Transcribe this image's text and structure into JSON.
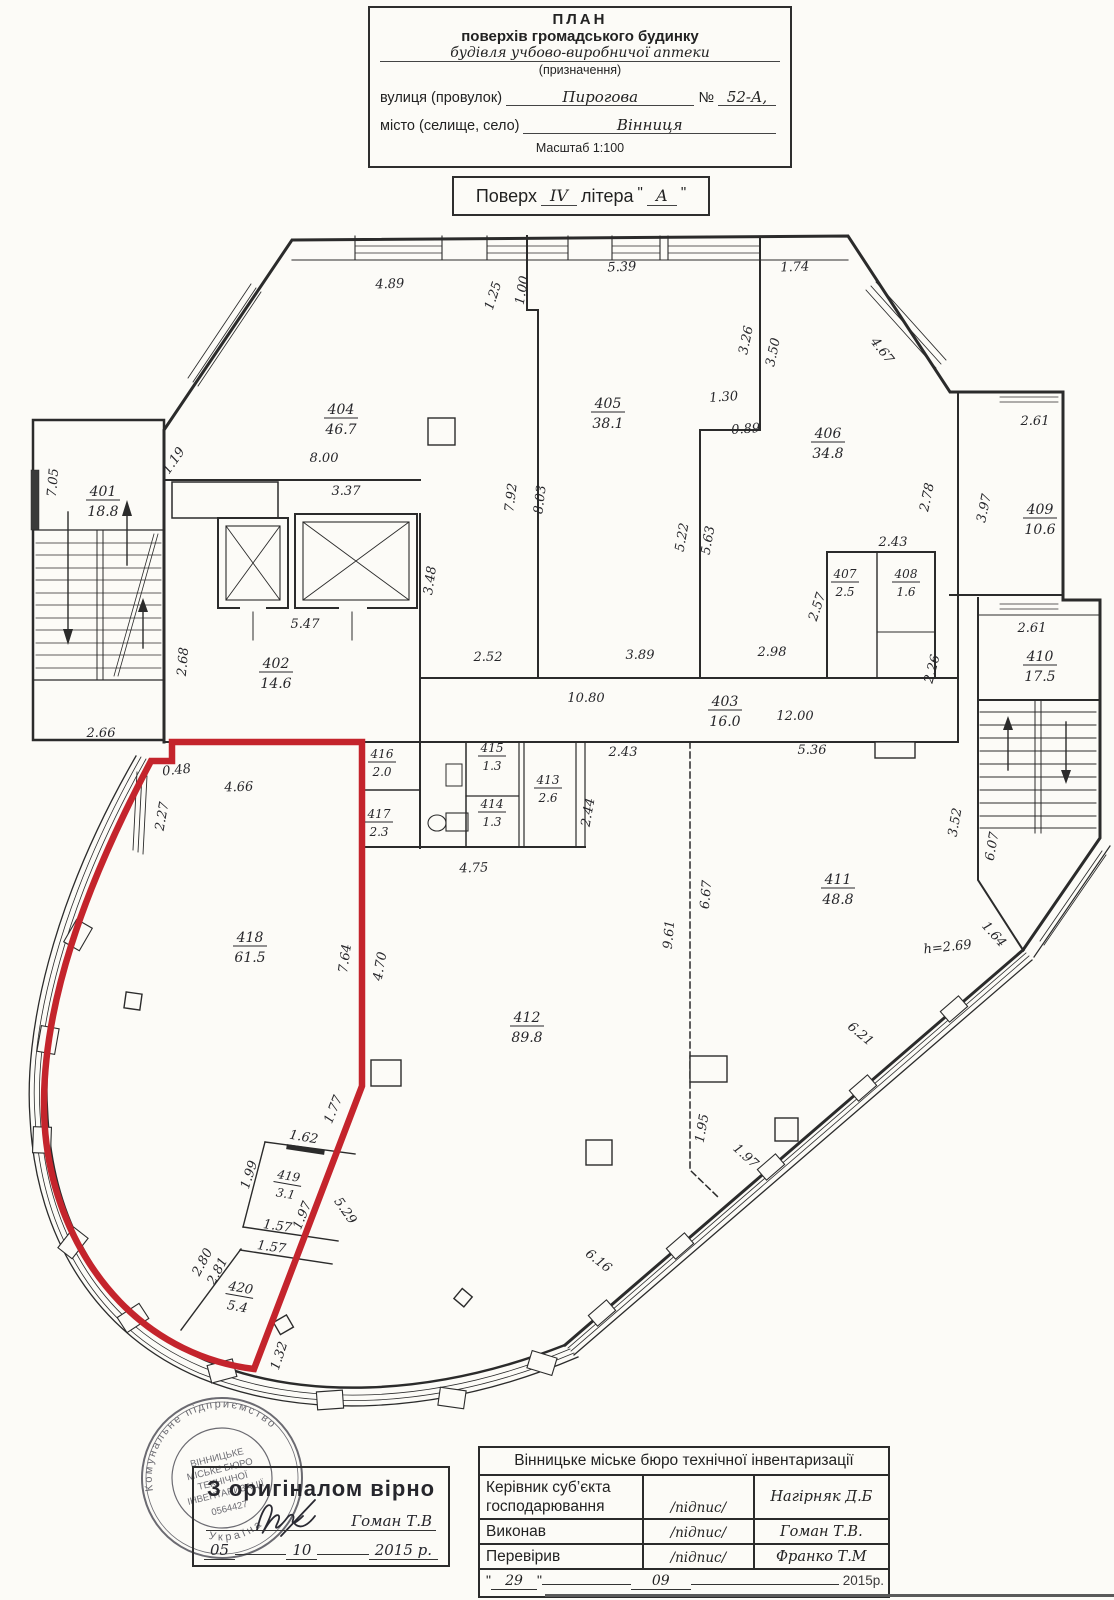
{
  "header": {
    "title_line1": "ПЛАН",
    "title_line2": "поверхів громадського будинку",
    "subtitle_value": "будівля учбово-виробничої аптеки",
    "subtitle_caption": "(призначення)",
    "street_label": "вулиця (провулок)",
    "street_value": "Пирогова",
    "number_label": "№",
    "number_value": "52-А,",
    "city_label": "місто (селище, село)",
    "city_value": "Вінниця",
    "scale": "Масштаб 1:100",
    "floor_label": "Поверх",
    "floor_value": "IV",
    "letter_label": "літера",
    "letter_value": "А",
    "quote": "\""
  },
  "plan": {
    "rooms": [
      {
        "n": "401",
        "a": "18.8",
        "x": 103,
        "y": 496
      },
      {
        "n": "402",
        "a": "14.6",
        "x": 276,
        "y": 668
      },
      {
        "n": "403",
        "a": "16.0",
        "x": 725,
        "y": 706
      },
      {
        "n": "404",
        "a": "46.7",
        "x": 341,
        "y": 414
      },
      {
        "n": "405",
        "a": "38.1",
        "x": 608,
        "y": 408
      },
      {
        "n": "406",
        "a": "34.8",
        "x": 828,
        "y": 438
      },
      {
        "n": "407",
        "a": "2.5",
        "x": 845,
        "y": 578,
        "s": 12
      },
      {
        "n": "408",
        "a": "1.6",
        "x": 906,
        "y": 578,
        "s": 12
      },
      {
        "n": "409",
        "a": "10.6",
        "x": 1040,
        "y": 514
      },
      {
        "n": "410",
        "a": "17.5",
        "x": 1040,
        "y": 661
      },
      {
        "n": "411",
        "a": "48.8",
        "x": 838,
        "y": 884
      },
      {
        "n": "412",
        "a": "89.8",
        "x": 527,
        "y": 1022
      },
      {
        "n": "413",
        "a": "2.6",
        "x": 548,
        "y": 784,
        "s": 12
      },
      {
        "n": "414",
        "a": "1.3",
        "x": 492,
        "y": 808,
        "s": 12
      },
      {
        "n": "415",
        "a": "1.3",
        "x": 492,
        "y": 752,
        "s": 12
      },
      {
        "n": "416",
        "a": "2.0",
        "x": 382,
        "y": 758,
        "s": 12
      },
      {
        "n": "417",
        "a": "2.3",
        "x": 379,
        "y": 818,
        "s": 12
      },
      {
        "n": "418",
        "a": "61.5",
        "x": 250,
        "y": 942
      },
      {
        "n": "419",
        "a": "3.1",
        "x": 288,
        "y": 1180,
        "r": 10,
        "s": 12
      },
      {
        "n": "420",
        "a": "5.4",
        "x": 240,
        "y": 1292,
        "r": 10,
        "s": 13
      }
    ],
    "dims": [
      {
        "t": "4.89",
        "x": 390,
        "y": 288,
        "r": -2
      },
      {
        "t": "5.39",
        "x": 622,
        "y": 271,
        "r": -2
      },
      {
        "t": "1.74",
        "x": 795,
        "y": 271,
        "r": -2
      },
      {
        "t": "1.25",
        "x": 497,
        "y": 297,
        "r": -72
      },
      {
        "t": "1.00",
        "x": 526,
        "y": 291,
        "r": -80
      },
      {
        "t": "3.26",
        "x": 750,
        "y": 341,
        "r": -78
      },
      {
        "t": "3.50",
        "x": 777,
        "y": 353,
        "r": -78
      },
      {
        "t": "4.67",
        "x": 879,
        "y": 353,
        "r": 52
      },
      {
        "t": "2.61",
        "x": 1035,
        "y": 425,
        "r": 0
      },
      {
        "t": "1.19",
        "x": 177,
        "y": 463,
        "r": -55
      },
      {
        "t": "7.05",
        "x": 57,
        "y": 483,
        "r": -85
      },
      {
        "t": "8.00",
        "x": 324,
        "y": 462,
        "r": 0
      },
      {
        "t": "3.37",
        "x": 346,
        "y": 495,
        "r": 0
      },
      {
        "t": "7.92",
        "x": 515,
        "y": 498,
        "r": -83
      },
      {
        "t": "8.03",
        "x": 544,
        "y": 500,
        "r": -83
      },
      {
        "t": "1.30",
        "x": 724,
        "y": 401,
        "r": -4
      },
      {
        "t": "0.89",
        "x": 746,
        "y": 433,
        "r": -4
      },
      {
        "t": "2.78",
        "x": 931,
        "y": 498,
        "r": -78
      },
      {
        "t": "3.97",
        "x": 988,
        "y": 509,
        "r": -78
      },
      {
        "t": "2.43",
        "x": 893,
        "y": 546,
        "r": 0
      },
      {
        "t": "5.22",
        "x": 686,
        "y": 538,
        "r": -80
      },
      {
        "t": "5.63",
        "x": 712,
        "y": 541,
        "r": -80
      },
      {
        "t": "2.57",
        "x": 821,
        "y": 608,
        "r": -72
      },
      {
        "t": "3.48",
        "x": 434,
        "y": 581,
        "r": -82
      },
      {
        "t": "5.47",
        "x": 305,
        "y": 628,
        "r": 0
      },
      {
        "t": "2.68",
        "x": 187,
        "y": 662,
        "r": -85
      },
      {
        "t": "2.52",
        "x": 488,
        "y": 661,
        "r": 0
      },
      {
        "t": "3.89",
        "x": 640,
        "y": 659,
        "r": 0
      },
      {
        "t": "2.98",
        "x": 772,
        "y": 656,
        "r": 0
      },
      {
        "t": "10.80",
        "x": 586,
        "y": 702,
        "r": 0
      },
      {
        "t": "12.00",
        "x": 795,
        "y": 720,
        "r": 0
      },
      {
        "t": "2.66",
        "x": 101,
        "y": 737,
        "r": 0
      },
      {
        "t": "2.26",
        "x": 936,
        "y": 670,
        "r": -75
      },
      {
        "t": "2.61",
        "x": 1032,
        "y": 632,
        "r": 0
      },
      {
        "t": "5.36",
        "x": 812,
        "y": 754,
        "r": 0
      },
      {
        "t": "2.43",
        "x": 623,
        "y": 756,
        "r": 0
      },
      {
        "t": "0.48",
        "x": 177,
        "y": 774,
        "r": -6
      },
      {
        "t": "4.66",
        "x": 239,
        "y": 791,
        "r": -2
      },
      {
        "t": "2.27",
        "x": 166,
        "y": 817,
        "r": -80
      },
      {
        "t": "2.44",
        "x": 592,
        "y": 813,
        "r": -80
      },
      {
        "t": "4.75",
        "x": 474,
        "y": 872,
        "r": -2
      },
      {
        "t": "3.52",
        "x": 959,
        "y": 823,
        "r": -80
      },
      {
        "t": "6.07",
        "x": 996,
        "y": 847,
        "r": -80
      },
      {
        "t": "6.67",
        "x": 710,
        "y": 895,
        "r": -85
      },
      {
        "t": "9.61",
        "x": 673,
        "y": 935,
        "r": -85
      },
      {
        "t": "7.64",
        "x": 349,
        "y": 959,
        "r": -82
      },
      {
        "t": "4.70",
        "x": 384,
        "y": 967,
        "r": -80
      },
      {
        "t": "1.64",
        "x": 991,
        "y": 937,
        "r": 48
      },
      {
        "t": "h=2.69",
        "x": 948,
        "y": 951,
        "r": -6
      },
      {
        "t": "6.21",
        "x": 858,
        "y": 1037,
        "r": 40
      },
      {
        "t": "1.95",
        "x": 706,
        "y": 1129,
        "r": -80
      },
      {
        "t": "1.97",
        "x": 743,
        "y": 1159,
        "r": 42
      },
      {
        "t": "6.16",
        "x": 596,
        "y": 1264,
        "r": 38
      },
      {
        "t": "1.77",
        "x": 337,
        "y": 1111,
        "r": -68
      },
      {
        "t": "1.62",
        "x": 303,
        "y": 1141,
        "r": 10
      },
      {
        "t": "1.99",
        "x": 253,
        "y": 1176,
        "r": -72
      },
      {
        "t": "1.97",
        "x": 306,
        "y": 1217,
        "r": -68
      },
      {
        "t": "5.29",
        "x": 342,
        "y": 1213,
        "r": 55
      },
      {
        "t": "1.57",
        "x": 277,
        "y": 1230,
        "r": 8
      },
      {
        "t": "1.57",
        "x": 271,
        "y": 1251,
        "r": 8
      },
      {
        "t": "2.80",
        "x": 206,
        "y": 1264,
        "r": -62
      },
      {
        "t": "2.81",
        "x": 221,
        "y": 1273,
        "r": -62
      },
      {
        "t": "1.32",
        "x": 283,
        "y": 1357,
        "r": -72
      }
    ]
  },
  "stamp": {
    "certify": "З оригіналом вірно",
    "name": "Гоман Т.В",
    "day": "05",
    "month": "10",
    "year": "2015 р.",
    "round_top": "Комунальне  підприємство",
    "round_bottom": "Україна",
    "round_line1": "ВІННИЦЬКЕ",
    "round_line2": "МІСЬКЕ БЮРО",
    "round_line3": "ТЕХНІЧНОЇ",
    "round_line4": "ІНВЕНТАРИЗАЦІЇ",
    "round_number": "0564427"
  },
  "table": {
    "title": "Вінницьке міське бюро технічної інвентаризації",
    "rows": [
      {
        "label": "Керівник суб’єкта господарювання",
        "sign": "/підпис/",
        "name": "Нагірняк Д.Б"
      },
      {
        "label": "Виконав",
        "sign": "/підпис/",
        "name": "Гоман Т.В."
      },
      {
        "label": "Перевірив",
        "sign": "/підпис/",
        "name": "Франко Т.М"
      }
    ],
    "date_quote": "\"",
    "date_day": "29",
    "date_month": "09",
    "date_year": "2015р."
  },
  "colors": {
    "ink": "#2b2b2b",
    "red": "#c4242c"
  }
}
